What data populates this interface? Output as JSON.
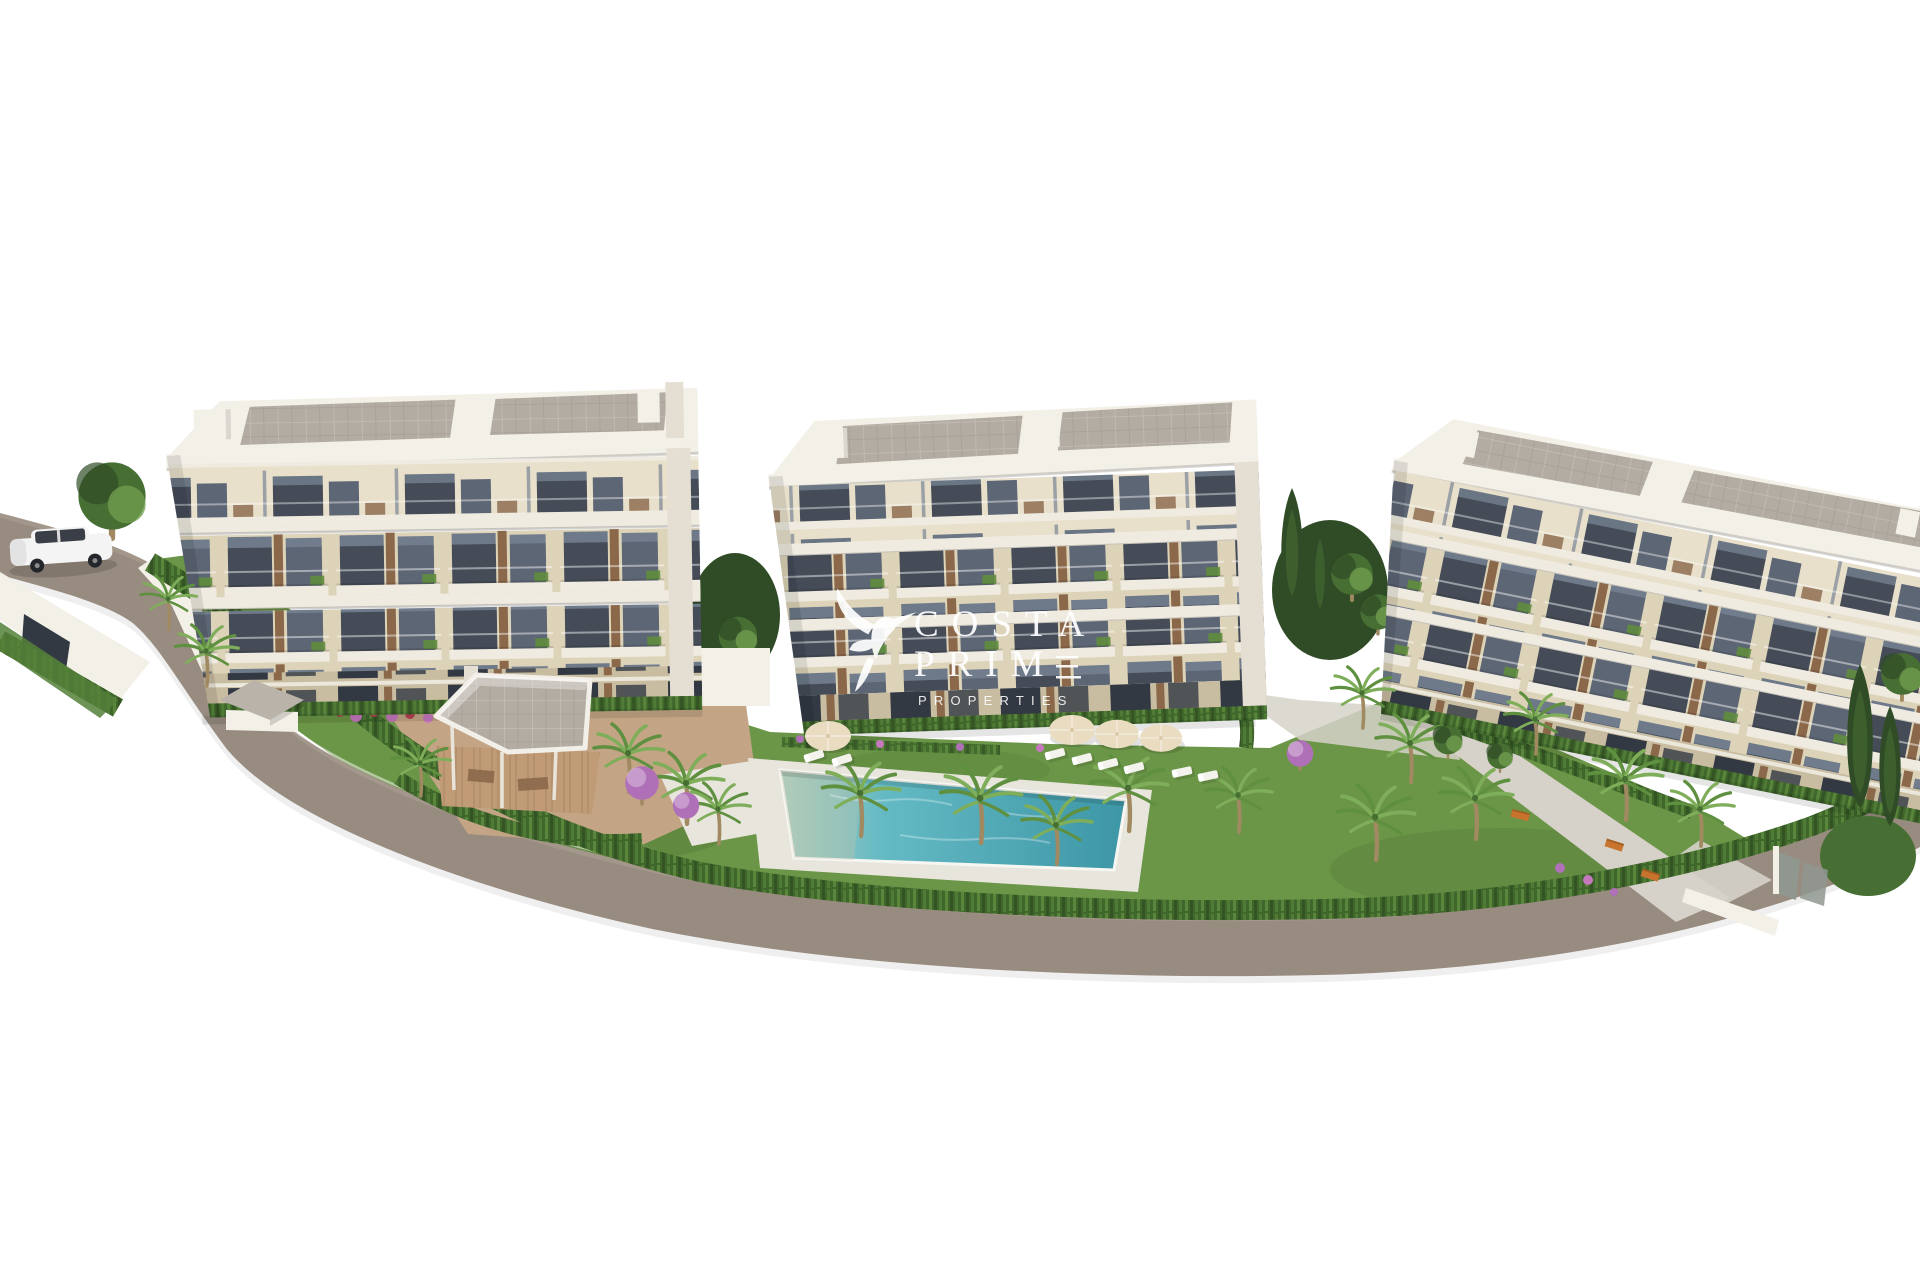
{
  "meta": {
    "type": "3d-architectural-render",
    "subject": "Aerial rendering of a new-build residential complex: three cream apartment blocks around a landscaped communal garden with swimming pool",
    "background": "white studio sky"
  },
  "watermark": {
    "logo": "hummingbird-icon",
    "line1": "COSTA",
    "line2_letters": "PRIM",
    "line2_final_letter": "E",
    "line2_final_letter_style": "three-horizontal-bars",
    "line3": "PROPERTIES"
  },
  "scene": {
    "buildings": [
      {
        "id": "apartment-building-left",
        "levels_visible": 4,
        "features": "flat roof deck, penthouse terraces, balconies with plants and furniture"
      },
      {
        "id": "apartment-building-middle",
        "levels_visible": 4,
        "features": "flat roof deck, penthouse terraces, balconies with plants and furniture"
      },
      {
        "id": "apartment-building-right",
        "levels_visible": 4,
        "features": "angled toward viewer, flat roof deck, balconies, ground-floor garden terraces"
      }
    ],
    "amenities": {
      "swimming_pool": 1,
      "garden_pavilion": 1,
      "gatehouse": 1,
      "sun_umbrellas": 4,
      "sun_loungers": 8,
      "garden_benches": 3,
      "palm_trees": 18,
      "white_car": 1,
      "entrance_gate": 1
    }
  },
  "colors": {
    "sky": "#ffffff",
    "wall": "#ddd3b8",
    "wall_light": "#e8e0cb",
    "wall_shade": "#c9bda1",
    "trim": "#f3f0e8",
    "slab": "#efebe0",
    "roof_panel": "#b3aca2",
    "glass": "#454c58",
    "glass2": "#5d6675",
    "glass_dark": "#333943",
    "glass_light": "#8fa0b0",
    "wood": "#8b684a",
    "grass": "#6b9547",
    "grass_dark": "#55803a",
    "hedge_dark": "#3f672c",
    "hedge_light": "#5f8c3d",
    "palm_frond": "#5f9040",
    "palm_frond_light": "#7fae5a",
    "trunk": "#a18a62",
    "pool_shallow": "#a9cfc0",
    "pool_mid": "#64bac4",
    "pool_deep": "#3d96a6",
    "pool_deck": "#e8e5dd",
    "road": "#a3968a",
    "path_tan": "#c3a585",
    "path_light": "#d6d2c9",
    "deck_wood": "#c19b76",
    "flower_pink": "#c678bd",
    "flower_red": "#b54050",
    "flower_purple": "#b070b8",
    "umbrella": "#e9dcc0",
    "lounger": "#f4f2ec",
    "bench_orange": "#c8742e",
    "tree_dark": "#2f4c27",
    "tree_mid": "#476f33",
    "tree_light": "#6f9c4e",
    "car_body": "#f4f4f4",
    "car_glass": "#3a3f47",
    "gate": "#8f978f",
    "watermark": "#ffffff"
  }
}
